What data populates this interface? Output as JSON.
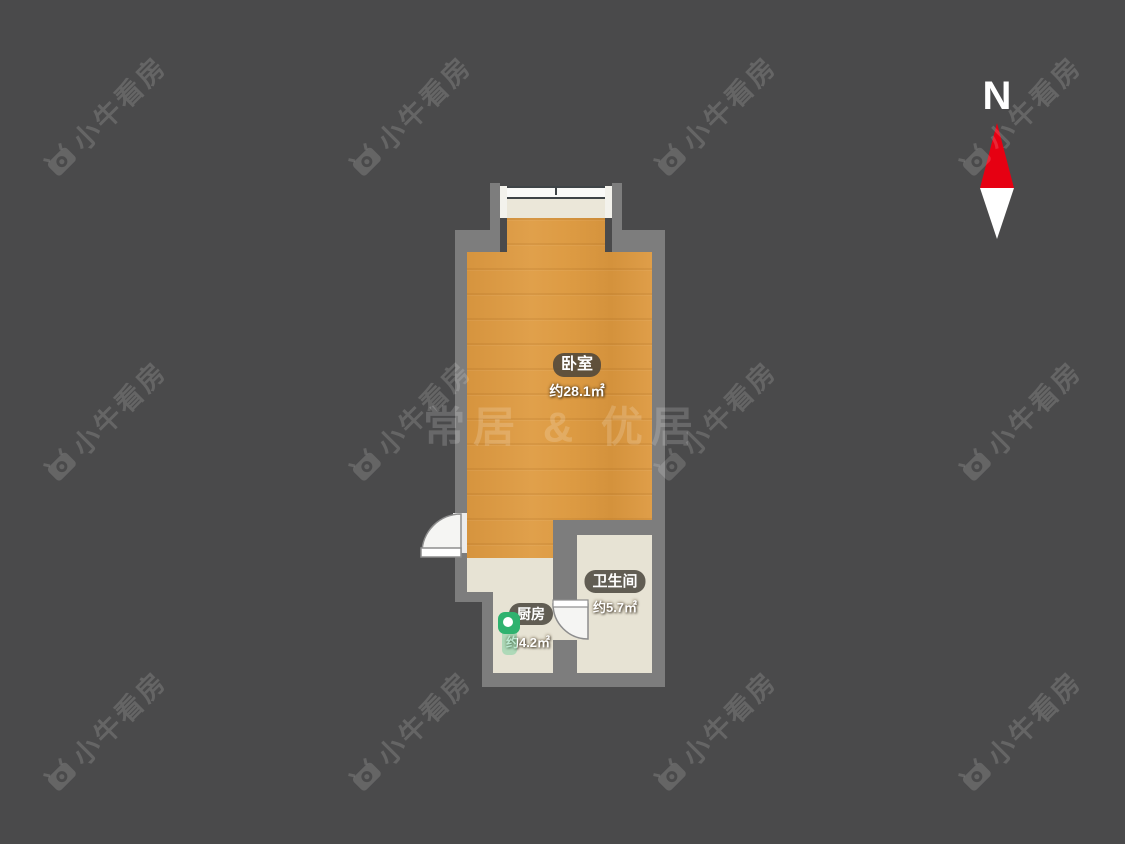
{
  "canvas": {
    "width": 1125,
    "height": 844,
    "background": "#4a4a4b"
  },
  "compass": {
    "label": "N",
    "red": "#e60012",
    "white": "#ffffff"
  },
  "rooms": [
    {
      "id": "bedroom",
      "name": "卧室",
      "area": "约28.1㎡",
      "floor_color": "#dd9b43"
    },
    {
      "id": "bathroom",
      "name": "卫生间",
      "area": "约5.7㎡",
      "floor_color": "#e7e3d4"
    },
    {
      "id": "kitchen",
      "name": "厨房",
      "area": "约4.2㎡",
      "floor_color": "#e7e3d4"
    }
  ],
  "center_watermark": {
    "text": "常居 & 优居"
  },
  "watermark_tile": {
    "text": "小牛看房",
    "icon": "niu-camera-icon",
    "color": "rgba(255,255,255,0.15)",
    "rotation_deg": -45,
    "cols": [
      105,
      410,
      715,
      1020
    ],
    "rows": [
      115,
      420,
      730
    ]
  },
  "colors": {
    "wall": "#7d7d7d",
    "label_pill_bg": "rgba(72,67,58,0.84)",
    "pin_green": "#2fb26f",
    "window_line": "#3f4447"
  }
}
